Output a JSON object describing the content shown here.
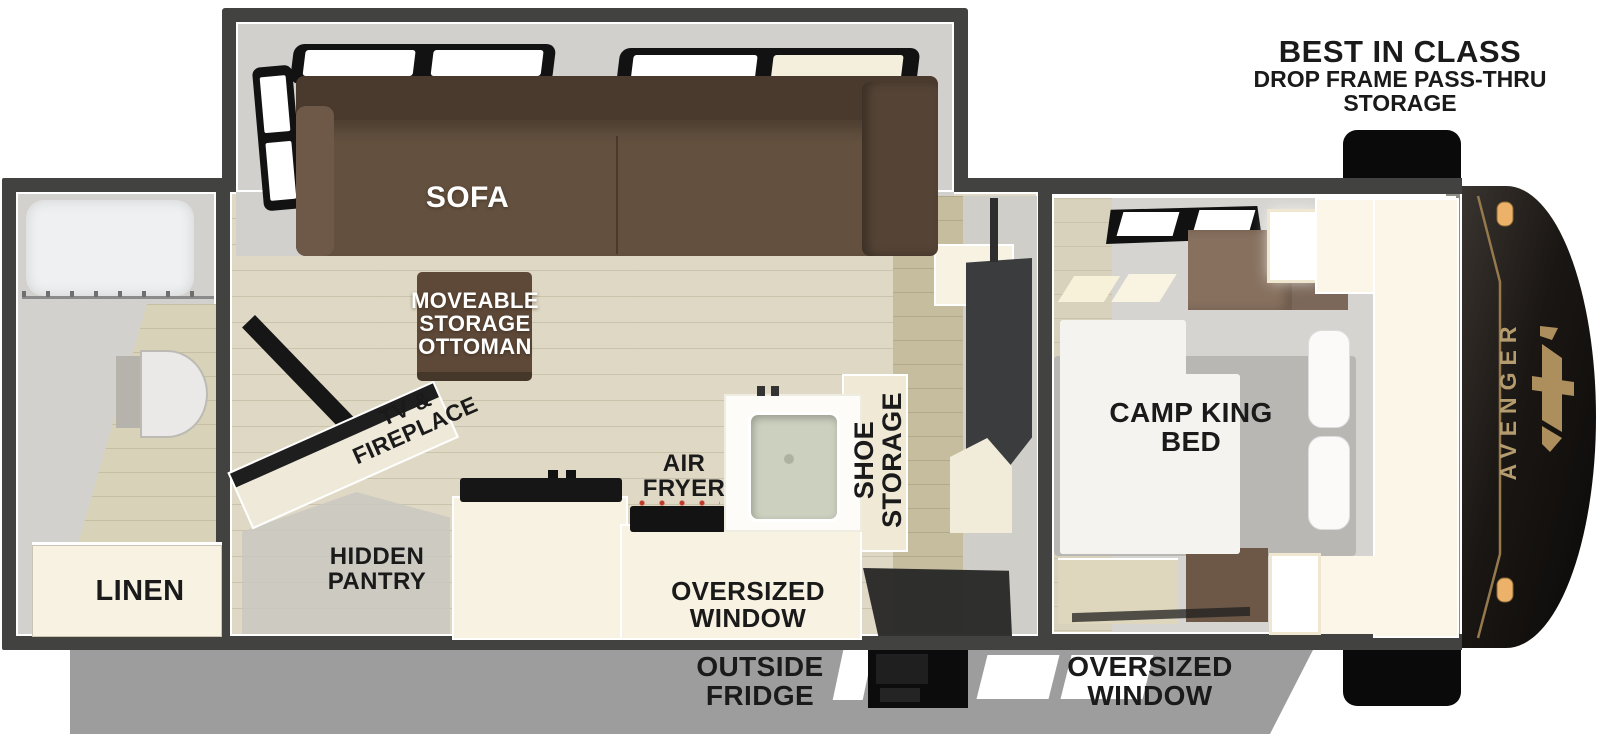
{
  "title_block": {
    "line1": "BEST IN CLASS",
    "line2": "DROP FRAME PASS-THRU",
    "line3": "STORAGE"
  },
  "plan_labels": {
    "sofa": "SOFA",
    "ottoman": {
      "l1": "MOVEABLE",
      "l2": "STORAGE",
      "l3": "OTTOMAN"
    },
    "tv_fireplace": {
      "l1": "TV &",
      "l2": "FIREPLACE"
    },
    "hidden_pantry": {
      "l1": "HIDDEN",
      "l2": "PANTRY"
    },
    "air_fryer": {
      "l1": "AIR",
      "l2": "FRYER"
    },
    "kitchen_window": {
      "l1": "OVERSIZED",
      "l2": "WINDOW"
    },
    "shoe_storage": {
      "l1": "SHOE",
      "l2": "STORAGE"
    },
    "camp_king_bed": {
      "l1": "CAMP KING",
      "l2": "BED"
    },
    "linen": "LINEN"
  },
  "exterior_labels": {
    "outside_fridge": {
      "l1": "OUTSIDE",
      "l2": "FRIDGE"
    },
    "oversized_window": {
      "l1": "OVERSIZED",
      "l2": "WINDOW"
    }
  },
  "brand": {
    "name": "AVENGER"
  },
  "colors": {
    "accent_gold": "#b59c6e",
    "cap_black": "#14110f",
    "wall_gray": "#424240",
    "sofa_brown": "#63503f",
    "ottoman_brown": "#5e4939",
    "cream": "#f7f2e1",
    "floor_wood": "#ded8c4",
    "exterior_gray": "#9d9d9d",
    "bed_gray": "#b9b7b4",
    "marker_red": "#c0392b",
    "label_black": "#1a1a1a",
    "label_white": "#ffffff"
  }
}
